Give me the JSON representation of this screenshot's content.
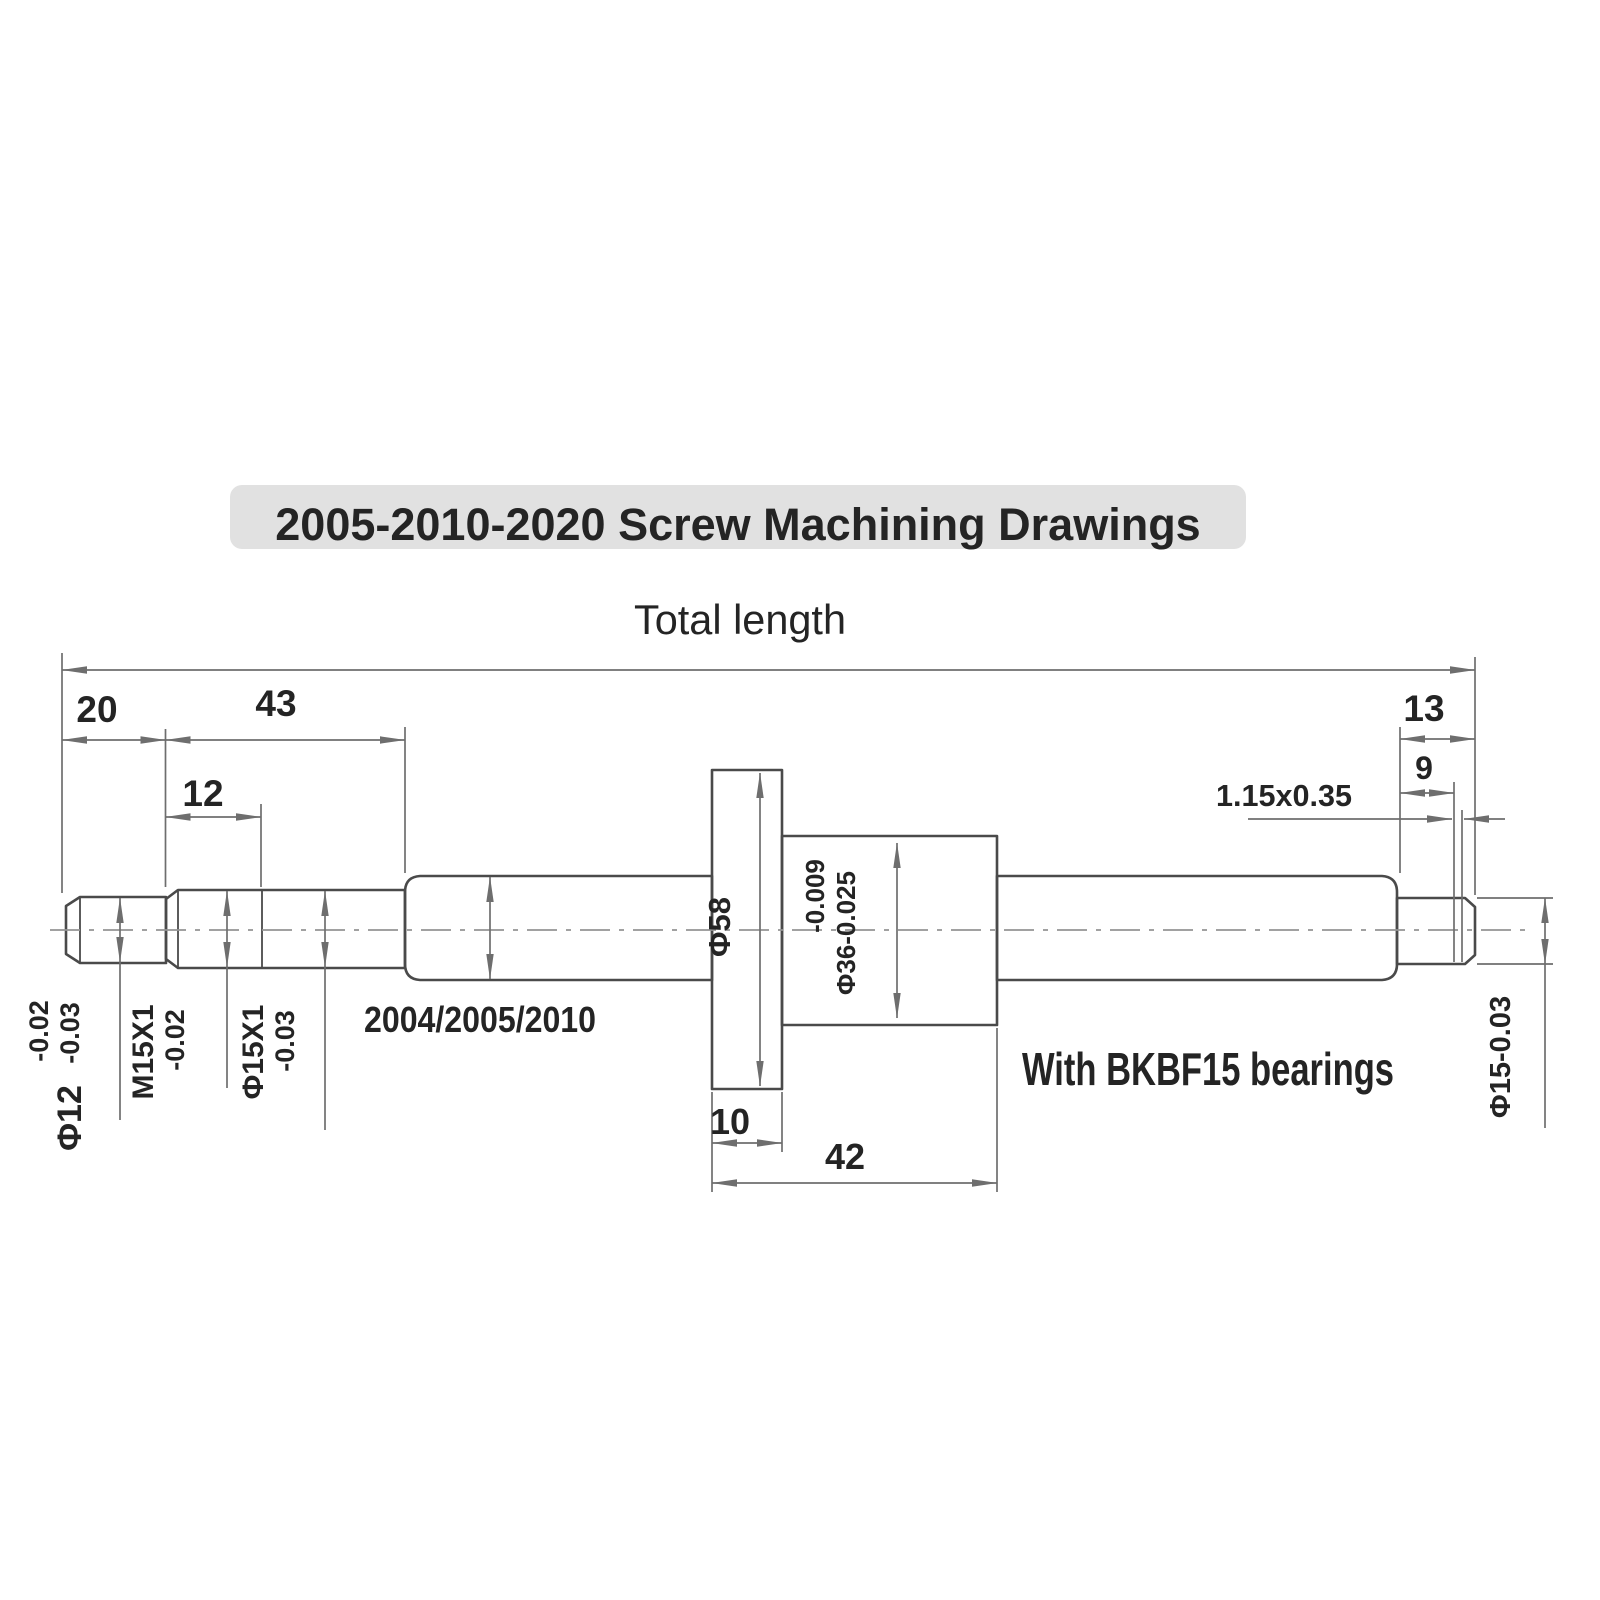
{
  "title": "2005-2010-2020  Screw Machining Drawings",
  "annotations": {
    "total_length": "Total length",
    "screw_types": "2004/2005/2010",
    "bearings_note": "With BKBF15 bearings",
    "groove_note": "1.15x0.35"
  },
  "dims": {
    "left_end": "20",
    "left_section": "43",
    "thread_length": "12",
    "right_end": "13",
    "right_journal": "9",
    "flange_width": "10",
    "nut_length": "42"
  },
  "labels": {
    "phi12_base": "Φ12",
    "phi12_tol_upper": "-0.02",
    "phi12_tol_lower": "-0.03",
    "m15_thread": "M15X1",
    "m15_tol": "-0.02",
    "phi15x1_base": "Φ15X1",
    "phi15x1_tol": "-0.03",
    "flange_dia": "Φ58",
    "nut_tol_upper": "-0.009",
    "nut_dia": "Φ36-0.025",
    "journal_dia": "Φ15-0.03"
  },
  "colors": {
    "outline": "#4a4a4a",
    "dim": "#6e6e6e",
    "center": "#949494",
    "title_bg": "#e1e1e1",
    "text": "#242424",
    "page": "#ffffff"
  }
}
